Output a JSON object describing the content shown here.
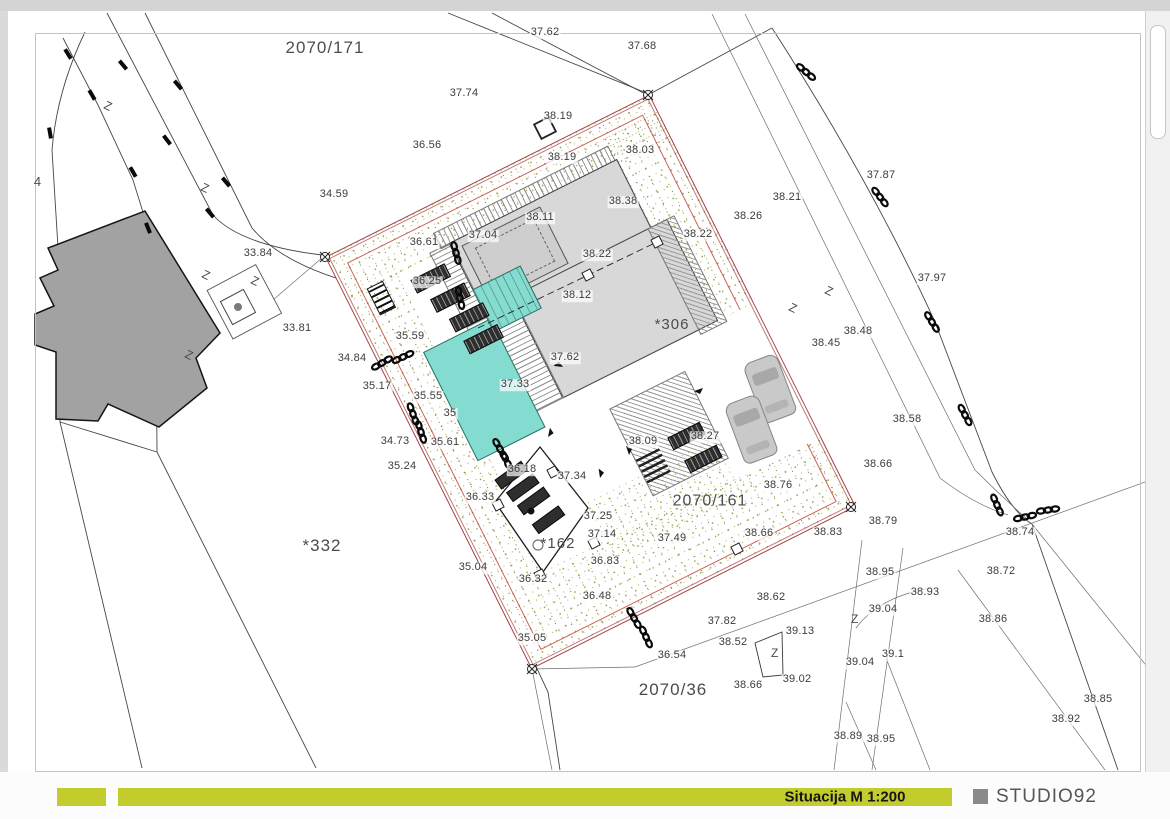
{
  "title_bar": {
    "label": "Situacija M 1:200",
    "brand": "STUDIO92"
  },
  "colors": {
    "accent": "#c3cc2d",
    "brand_square": "#8a8a8a",
    "pool": "#84dcd0",
    "vegetation_dot": "#8f9c3e",
    "boundary_red": "#a04343",
    "existing_building": "#a2a2a2",
    "new_building": "#d8d8d8"
  },
  "labels": {
    "plots": [
      [
        "2070/171",
        325,
        48,
        17
      ],
      [
        "2070/161",
        710,
        502,
        16
      ],
      [
        "2070/36",
        673,
        690,
        17
      ],
      [
        "*332",
        322,
        546,
        17
      ],
      [
        "*306",
        672,
        325,
        15
      ],
      [
        "*162",
        558,
        544,
        15
      ],
      [
        "4",
        38,
        182,
        13
      ]
    ],
    "elevations": [
      [
        "37.62",
        545,
        33
      ],
      [
        "37.68",
        642,
        47
      ],
      [
        "37.74",
        464,
        94
      ],
      [
        "38.19",
        558,
        117
      ],
      [
        "36.56",
        427,
        146
      ],
      [
        "38.19",
        562,
        158
      ],
      [
        "38.03",
        640,
        151
      ],
      [
        "34.59",
        334,
        195
      ],
      [
        "38.38",
        623,
        202
      ],
      [
        "38.11",
        540,
        218
      ],
      [
        "37.04",
        483,
        236
      ],
      [
        "36.61",
        424,
        243
      ],
      [
        "38.22",
        597,
        255
      ],
      [
        "38.22",
        698,
        235
      ],
      [
        "38.21",
        787,
        198
      ],
      [
        "38.26",
        748,
        217
      ],
      [
        "37.87",
        881,
        176
      ],
      [
        "33.84",
        258,
        254
      ],
      [
        "36.25",
        427,
        282
      ],
      [
        "33.81",
        297,
        329
      ],
      [
        "38.12",
        577,
        296
      ],
      [
        "37.97",
        932,
        279
      ],
      [
        "38.48",
        858,
        332
      ],
      [
        "38.45",
        826,
        344
      ],
      [
        "35.59",
        410,
        337
      ],
      [
        "34.84",
        352,
        359
      ],
      [
        "37.62",
        565,
        358
      ],
      [
        "35.17",
        377,
        387
      ],
      [
        "37.33",
        515,
        385
      ],
      [
        "35.55",
        428,
        397
      ],
      [
        "35",
        450,
        414
      ],
      [
        "38.58",
        907,
        420
      ],
      [
        "34.73",
        395,
        442
      ],
      [
        "35.61",
        445,
        443
      ],
      [
        "38.09",
        643,
        442
      ],
      [
        "38.27",
        705,
        437
      ],
      [
        "35.24",
        402,
        467
      ],
      [
        "36.18",
        522,
        470
      ],
      [
        "37.34",
        572,
        477
      ],
      [
        "38.66",
        878,
        465
      ],
      [
        "36.33",
        480,
        498
      ],
      [
        "38.76",
        778,
        486
      ],
      [
        "37.25",
        598,
        517
      ],
      [
        "38.79",
        883,
        522
      ],
      [
        "38.74",
        1020,
        533
      ],
      [
        "37.14",
        602,
        535
      ],
      [
        "37.49",
        672,
        539
      ],
      [
        "38.66",
        759,
        534
      ],
      [
        "38.83",
        828,
        533
      ],
      [
        "36.83",
        605,
        562
      ],
      [
        "35.04",
        473,
        568
      ],
      [
        "36.32",
        533,
        580
      ],
      [
        "38.72",
        1001,
        572
      ],
      [
        "38.95",
        880,
        573
      ],
      [
        "38.93",
        925,
        593
      ],
      [
        "36.48",
        597,
        597
      ],
      [
        "38.86",
        993,
        620
      ],
      [
        "39.04",
        883,
        610
      ],
      [
        "38.62",
        771,
        598
      ],
      [
        "35.05",
        532,
        639
      ],
      [
        "37.82",
        722,
        622
      ],
      [
        "39.13",
        800,
        632
      ],
      [
        "38.52",
        733,
        643
      ],
      [
        "36.54",
        672,
        656
      ],
      [
        "39.04",
        860,
        663
      ],
      [
        "39.1",
        893,
        655
      ],
      [
        "38.66",
        748,
        686
      ],
      [
        "39.02",
        797,
        680
      ],
      [
        "38.85",
        1098,
        700
      ],
      [
        "38.92",
        1066,
        720
      ],
      [
        "38.89",
        848,
        737
      ],
      [
        "38.95",
        881,
        740
      ]
    ]
  },
  "symbols": {
    "z_glyph": "Z",
    "chains": [
      [
        806,
        72,
        40
      ],
      [
        880,
        197,
        52
      ],
      [
        932,
        322,
        58
      ],
      [
        965,
        415,
        62
      ],
      [
        997,
        505,
        66
      ],
      [
        1025,
        517,
        -12
      ],
      [
        1048,
        510,
        -8
      ],
      [
        456,
        253,
        75
      ],
      [
        460,
        298,
        78
      ],
      [
        382,
        363,
        -30
      ],
      [
        403,
        357,
        -25
      ],
      [
        413,
        414,
        70
      ],
      [
        421,
        432,
        72
      ],
      [
        500,
        449,
        60
      ],
      [
        508,
        464,
        65
      ],
      [
        634,
        618,
        60
      ],
      [
        646,
        637,
        65
      ]
    ],
    "ticks": [
      [
        68,
        54,
        58
      ],
      [
        92,
        95,
        60
      ],
      [
        123,
        65,
        50
      ],
      [
        167,
        140,
        52
      ],
      [
        50,
        133,
        80
      ],
      [
        210,
        213,
        50
      ],
      [
        133,
        172,
        60
      ],
      [
        148,
        228,
        68
      ],
      [
        178,
        85,
        50
      ],
      [
        226,
        182,
        50
      ]
    ],
    "z_marks": [
      [
        103,
        108,
        25
      ],
      [
        200,
        190,
        25
      ],
      [
        201,
        277,
        25
      ],
      [
        184,
        357,
        25
      ],
      [
        250,
        283,
        25
      ],
      [
        788,
        310,
        25
      ],
      [
        824,
        293,
        25
      ],
      [
        851,
        623,
        0
      ],
      [
        771,
        657,
        0
      ]
    ],
    "squares": [
      [
        553,
        472,
        -27,
        1
      ],
      [
        498,
        505,
        -27,
        1
      ],
      [
        540,
        575,
        -27,
        1
      ],
      [
        594,
        543,
        -27,
        1
      ],
      [
        737,
        549,
        -27,
        1
      ],
      [
        588,
        275,
        -27,
        1
      ],
      [
        657,
        242,
        -27,
        1
      ],
      [
        545,
        128,
        -27,
        1.8
      ]
    ],
    "corner_markers": [
      [
        648,
        95
      ],
      [
        325,
        257
      ],
      [
        851,
        507
      ],
      [
        532,
        669
      ]
    ],
    "arrows": [
      [
        563,
        367,
        -155
      ],
      [
        600,
        478,
        -80
      ],
      [
        548,
        437,
        -60
      ],
      [
        694,
        391,
        0
      ],
      [
        629,
        455,
        -90
      ]
    ]
  }
}
